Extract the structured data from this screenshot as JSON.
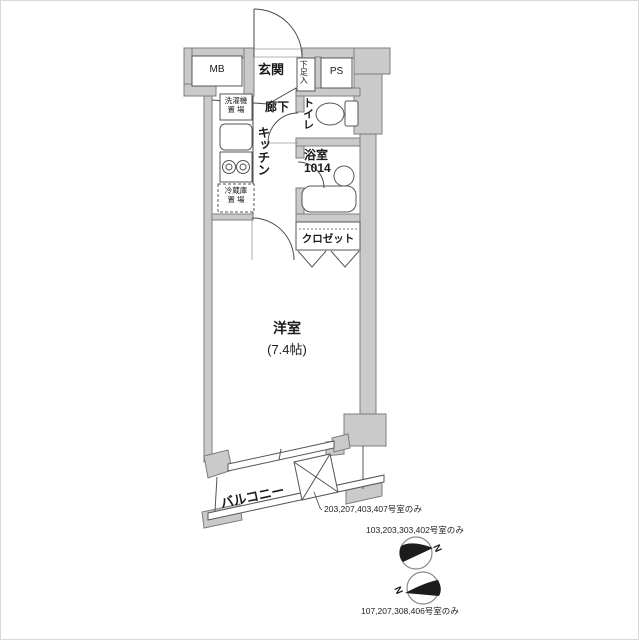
{
  "plan": {
    "rooms": {
      "mb": "MB",
      "genkan": "玄関",
      "shoe_box": "下足入",
      "ps": "PS",
      "hall": "廊下",
      "toilet": "トイレ",
      "washer_line1": "洗濯機",
      "washer_line2": "置 場",
      "kitchen": "キッチン",
      "bath_line1": "浴室",
      "bath_line2": "1014",
      "fridge_line1": "冷蔵庫",
      "fridge_line2": "置 場",
      "closet": "クロゼット",
      "main_room_line1": "洋室",
      "main_room_line2": "(7.4帖)",
      "balcony": "バルコニー"
    },
    "notes": {
      "hatch_note": "203,207,403,407号室のみ",
      "compass1_note": "103,203,303,402号室のみ",
      "compass2_note": "107,207,308,406号室のみ",
      "north1": "N",
      "north2": "N"
    },
    "colors": {
      "wall_fill": "#cacaca",
      "wall_stroke": "#7d7d7d",
      "line": "#4a4a4a",
      "north_fill": "#1c1c1c"
    }
  }
}
